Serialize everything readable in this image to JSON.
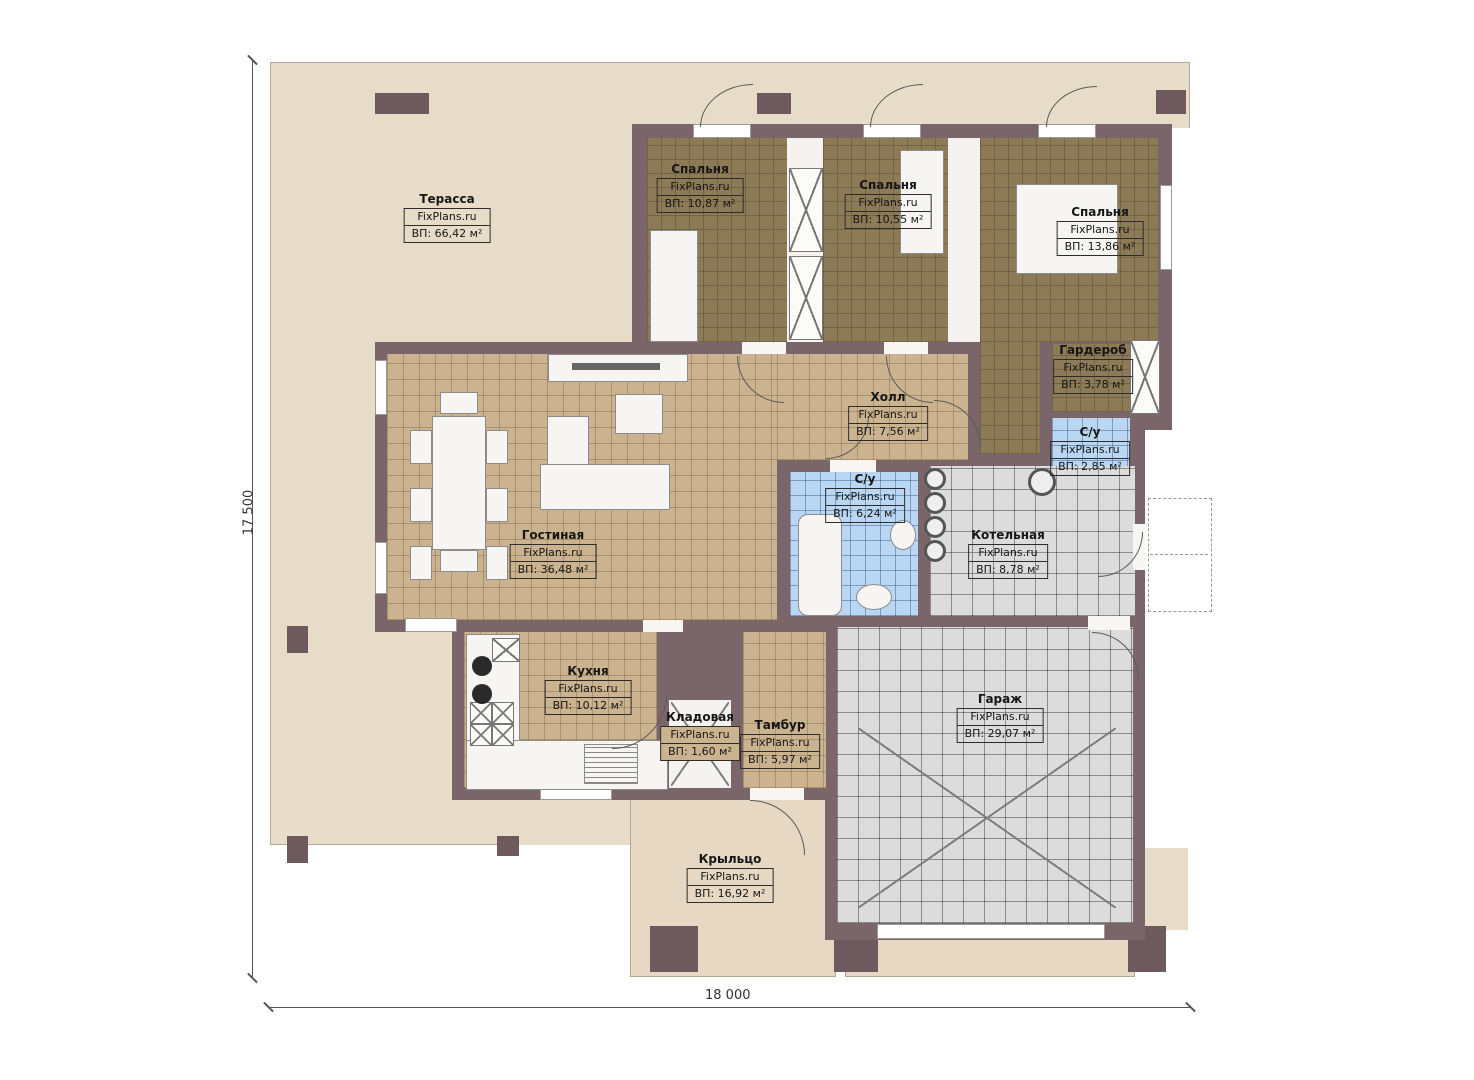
{
  "brand": "FixPlans.ru",
  "plan": {
    "type": "single-storey house floor plan",
    "dimensions": {
      "horizontal": "18 000",
      "vertical": "17 500"
    },
    "colors": {
      "wall": "#7a656a",
      "wood_floor": "#8d7b58",
      "tile_tan": "#cbb38f",
      "tile_blue": "#b9d7f2",
      "tile_grey": "#dcdcdc",
      "terrace": "#e7dcc7"
    },
    "rooms": [
      {
        "id": "terrace",
        "name": "Терасса",
        "area": "ВП: 66,42 м²"
      },
      {
        "id": "bedroom-1",
        "name": "Спальня",
        "area": "ВП: 10,87 м²"
      },
      {
        "id": "bedroom-2",
        "name": "Спальня",
        "area": "ВП: 10,55 м²"
      },
      {
        "id": "bedroom-3",
        "name": "Спальня",
        "area": "ВП: 13,86 м²"
      },
      {
        "id": "wardrobe",
        "name": "Гардероб",
        "area": "ВП: 3,78 м²"
      },
      {
        "id": "hall",
        "name": "Холл",
        "area": "ВП: 7,56 м²"
      },
      {
        "id": "wc-small",
        "name": "С/у",
        "area": "ВП: 2,85 м²"
      },
      {
        "id": "wc-big",
        "name": "С/у",
        "area": "ВП: 6,24 м²"
      },
      {
        "id": "boiler",
        "name": "Котельная",
        "area": "ВП: 8,78 м²"
      },
      {
        "id": "living",
        "name": "Гостиная",
        "area": "ВП: 36,48 м²"
      },
      {
        "id": "kitchen",
        "name": "Кухня",
        "area": "ВП: 10,12 м²"
      },
      {
        "id": "pantry",
        "name": "Кладовая",
        "area": "ВП: 1,60 м²"
      },
      {
        "id": "vestibule",
        "name": "Тамбур",
        "area": "ВП: 5,97 м²"
      },
      {
        "id": "garage",
        "name": "Гараж",
        "area": "ВП: 29,07 м²"
      },
      {
        "id": "stoop",
        "name": "Крыльцо",
        "area": "ВП: 16,92 м²"
      }
    ]
  }
}
